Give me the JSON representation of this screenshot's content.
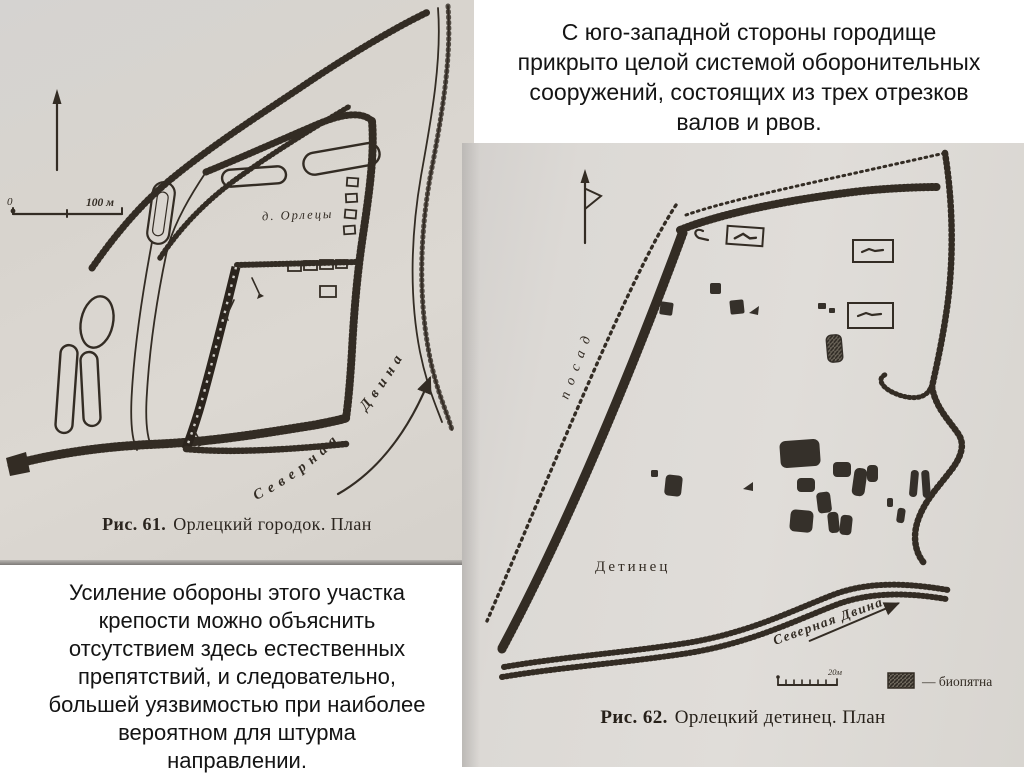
{
  "slide": {
    "background": "#ffffff",
    "top_text": {
      "lines": [
        "С юго-западной стороны городище",
        "прикрыто целой системой оборонительных",
        "сооружений, состоящих из трех отрезков",
        "валов и рвов."
      ]
    },
    "bottom_text": {
      "lines": [
        "Усиление обороны этого участка",
        "крепости можно объяснить",
        "отсутствием здесь естественных",
        "препятствий, и следовательно,",
        "большей уязвимостью при наиболее",
        "вероятном для штурма",
        "направлении."
      ]
    }
  },
  "fig61": {
    "caption_prefix": "Рис. 61.",
    "caption_text": "Орлецкий городок. План",
    "labels": {
      "village": "д. Орлецы",
      "river": "Северная  Двина",
      "scale_zero": "0",
      "scale_value": "100 м"
    }
  },
  "fig62": {
    "caption_prefix": "Рис. 62.",
    "caption_text": "Орлецкий детинец. План",
    "labels": {
      "posad": "посад",
      "detinets": "Детинец",
      "river": "Северная Двина",
      "scale_value": "20м",
      "legend": "— биопятна"
    }
  },
  "colors": {
    "paper_left": "#d8d4ce",
    "paper_right": "#dcd9d5",
    "ink": "#332c24",
    "text": "#141414"
  }
}
